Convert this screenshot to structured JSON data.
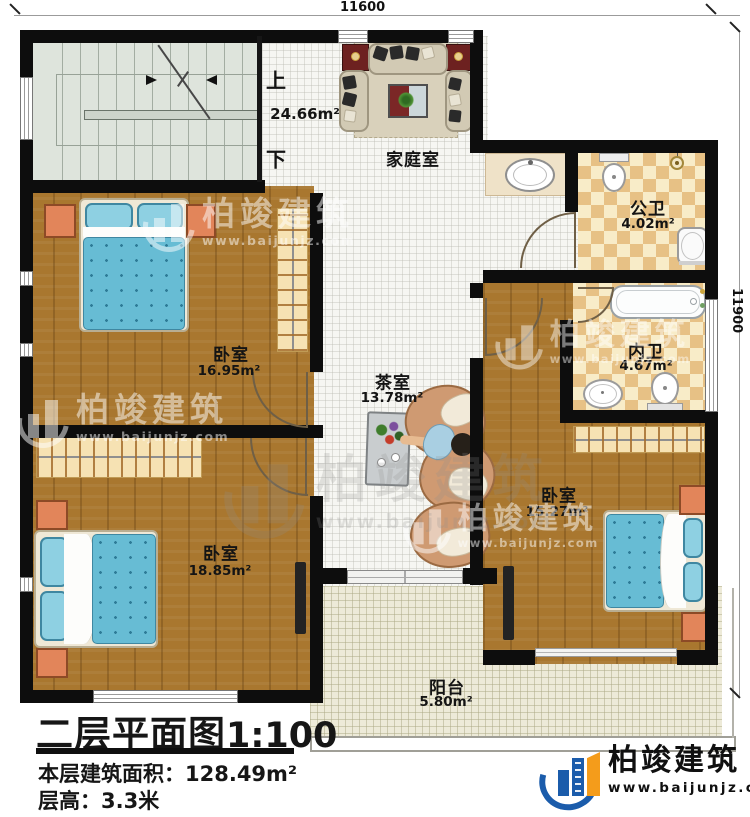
{
  "dims": {
    "top": "11600",
    "right": "11900"
  },
  "stairs": {
    "up": "上",
    "down": "下"
  },
  "rooms": {
    "family": {
      "name": "家庭室",
      "area": "24.66m²"
    },
    "tea": {
      "name": "茶室",
      "area": "13.78m²"
    },
    "public_bath": {
      "name": "公卫",
      "area": "4.02m²"
    },
    "ensuite_bath": {
      "name": "内卫",
      "area": "4.67m²"
    },
    "bedroom1": {
      "name": "卧室",
      "area": "16.95m²"
    },
    "bedroom2": {
      "name": "卧室",
      "area": "18.85m²"
    },
    "bedroom3": {
      "name": "卧室",
      "area": "15.27m²"
    },
    "balcony": {
      "name": "阳台",
      "area": "5.80m²"
    }
  },
  "title": {
    "plan": "二层平面图",
    "scale": "1:100",
    "area_label": "本层建筑面积：",
    "area_value": "128.49m²",
    "height_label": "层高：",
    "height_value": "3.3米"
  },
  "brand": {
    "name": "柏竣建筑",
    "url": "www.baijunjz.com"
  },
  "colors": {
    "wall": "#0d0d0d",
    "wood_floor": "#a9772f",
    "hall_tile": "#f6f6f2",
    "bath_checker_tan": "#e7c185",
    "bath_checker_cream": "#f8ecc8",
    "balcony_tile": "#edead8",
    "bed_blue": "#67bcd4",
    "brand_blue": "#1b5cab",
    "brand_orange": "#f49c1b"
  }
}
